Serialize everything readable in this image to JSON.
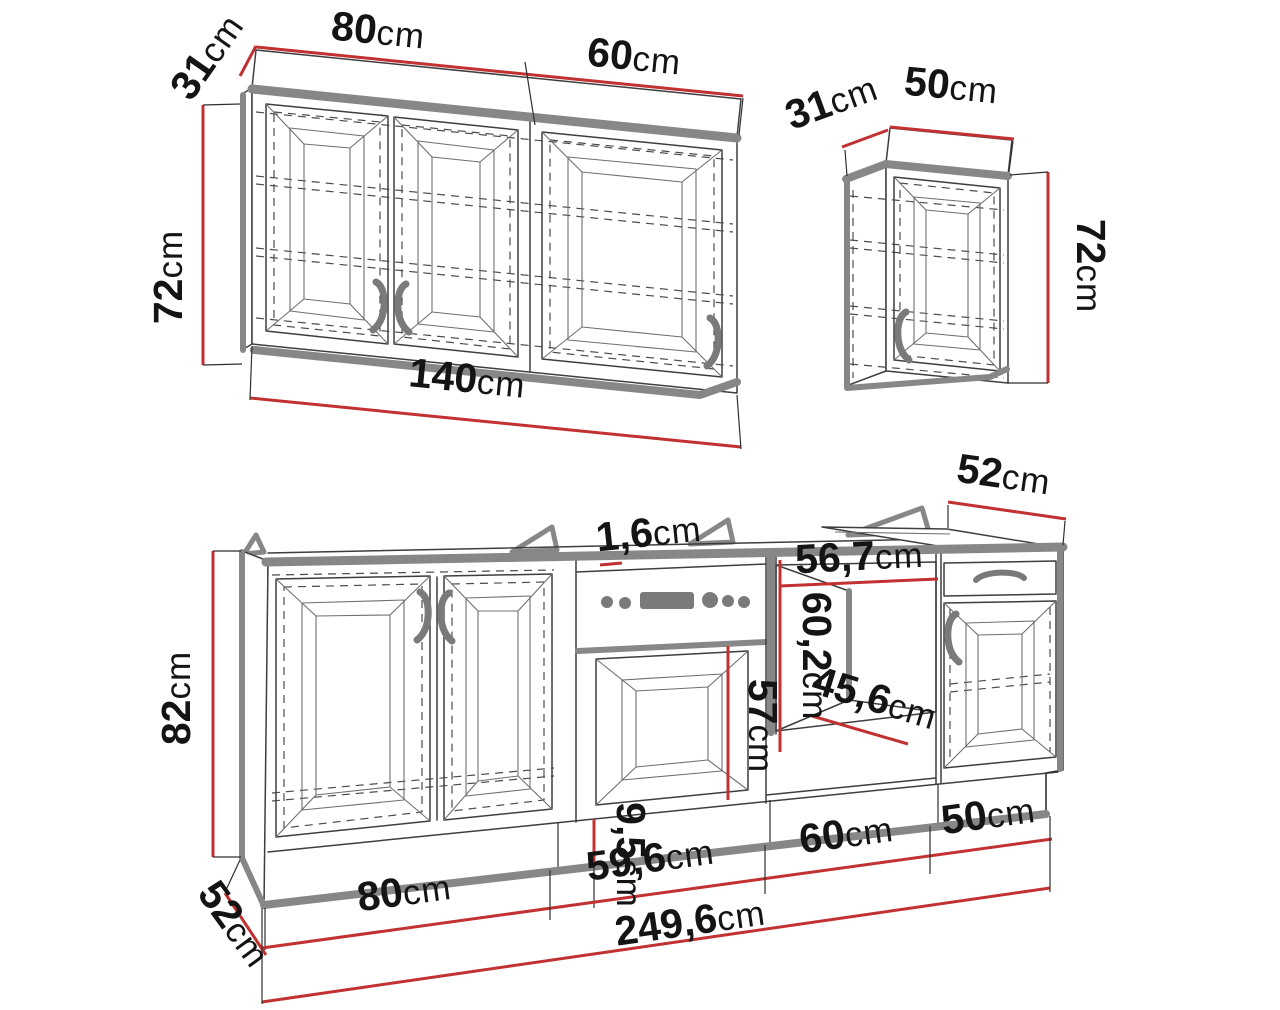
{
  "diagram": {
    "type": "kitchen cabinet set dimension drawing",
    "unit": "cm",
    "colors": {
      "dimension_line": "#c23131",
      "outline": "#3e3e3e",
      "accent_edge": "#878787",
      "background": "#ffffff"
    },
    "wall_cabinet_left": {
      "description": "three-door wall cabinet",
      "dims": {
        "depth": {
          "num": "31",
          "unit": "cm"
        },
        "section1_width": {
          "num": "80",
          "unit": "cm"
        },
        "section2_width": {
          "num": "60",
          "unit": "cm"
        },
        "height": {
          "num": "72",
          "unit": "cm"
        },
        "total_width": {
          "num": "140",
          "unit": "cm"
        }
      }
    },
    "wall_cabinet_right": {
      "description": "single-door wall cabinet",
      "dims": {
        "depth": {
          "num": "31",
          "unit": "cm"
        },
        "width": {
          "num": "50",
          "unit": "cm"
        },
        "height": {
          "num": "72",
          "unit": "cm"
        }
      }
    },
    "base_run": {
      "description": "base cabinet run with sink unit, oven housing, appliance niche and drawer unit",
      "dims": {
        "height": {
          "num": "82",
          "unit": "cm"
        },
        "side_depth": {
          "num": "52",
          "unit": "cm"
        },
        "right_depth": {
          "num": "52",
          "unit": "cm"
        },
        "worktop_thickness": {
          "num": "1,6",
          "unit": "cm"
        },
        "niche_width": {
          "num": "56,7",
          "unit": "cm"
        },
        "niche_height": {
          "num": "60,2",
          "unit": "cm"
        },
        "niche_depth": {
          "num": "45,6",
          "unit": "cm"
        },
        "oven_door_height": {
          "num": "57",
          "unit": "cm"
        },
        "plinth_height": {
          "num": "9,5",
          "unit": "cm"
        },
        "section1_width": {
          "num": "80",
          "unit": "cm"
        },
        "section2_width": {
          "num": "59,6",
          "unit": "cm"
        },
        "section3_width": {
          "num": "60",
          "unit": "cm"
        },
        "section4_width": {
          "num": "50",
          "unit": "cm"
        },
        "total_width": {
          "num": "249,6",
          "unit": "cm"
        }
      }
    }
  }
}
